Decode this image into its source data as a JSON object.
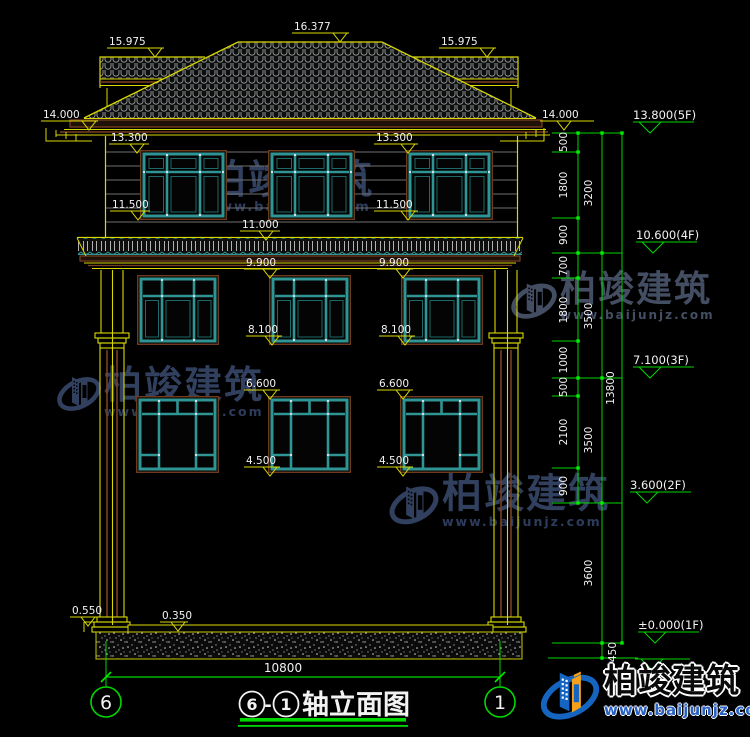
{
  "title_block": {
    "axis_from": "6",
    "axis_to": "1",
    "label": "轴立面图",
    "dash": "-"
  },
  "axes": {
    "left": "6",
    "right": "1"
  },
  "bottom_dim": {
    "span": "10800"
  },
  "lv": {
    "v16377": "16.377",
    "v15975": "15.975",
    "v14000": "14.000",
    "v13300": "13.300",
    "v11500": "11.500",
    "v11000": "11.000",
    "v9900": "9.900",
    "v8100": "8.100",
    "v6600": "6.600",
    "v4500": "4.500",
    "v0550": "0.550",
    "v0350": "0.350"
  },
  "floor_levels": {
    "f5": "13.800(5F)",
    "f4": "10.600(4F)",
    "f3": "7.100(3F)",
    "f2": "3.600(2F)",
    "f1": "±0.000(1F)"
  },
  "dims": {
    "d500": "500",
    "d700": "700",
    "d900": "900",
    "d1000": "1000",
    "d1800": "1800",
    "d2100": "2100",
    "d3200": "3200",
    "d3500": "3500",
    "d3600": "3600",
    "d450": "450",
    "d13800": "13800"
  },
  "watermark": {
    "brand": "柏竣建筑",
    "url": "www.baijunjz.com"
  },
  "footer_logo": {
    "brand": "柏竣建筑",
    "url": "www.baijunjz.com"
  },
  "colors": {
    "cad_yellow": "#d9d900",
    "cad_green": "#00d800",
    "window_teal": "#2f9494",
    "trim_brown": "#7a4020",
    "logo_blue": "#1565c0",
    "logo_orange": "#f5a21a"
  }
}
